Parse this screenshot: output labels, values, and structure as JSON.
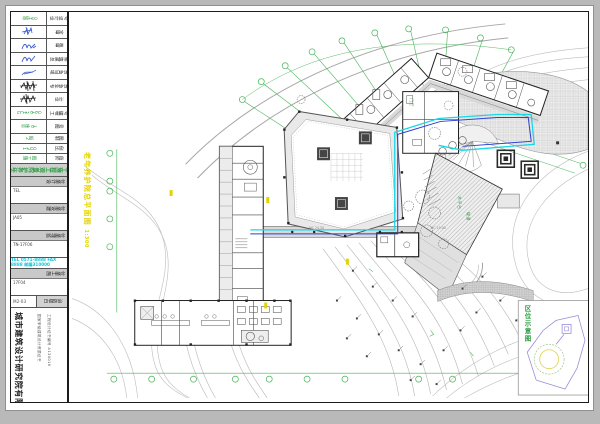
{
  "colors": {
    "grid_green": "#46b257",
    "highlight_cyan": "#18d7e6",
    "highlight_blue": "#2b3fd4",
    "title_yellow": "#e3d400",
    "contour_gray": "#b8b8b8"
  },
  "title_block": {
    "rows": [
      {
        "label": "设计证号",
        "value": "甲级100"
      },
      {
        "label": "审 定",
        "value": ""
      },
      {
        "label": "审 核",
        "value": ""
      },
      {
        "label": "总建筑师",
        "value": ""
      },
      {
        "label": "项目负责",
        "value": ""
      },
      {
        "label": "专业负责",
        "value": ""
      },
      {
        "label": "设 计",
        "value": ""
      },
      {
        "label": "工程编号",
        "value": "GC 13-0160"
      },
      {
        "label": "图 号",
        "value": "总施-01"
      }
    ],
    "info_rows": [
      {
        "label": "制 图",
        "value": "2期"
      },
      {
        "label": "比 例",
        "value": "1:300"
      },
      {
        "label": "阶 段",
        "value": "施工图"
      }
    ],
    "project_name": "老年养护院景观工程施工图",
    "sections": [
      {
        "code": "TEL",
        "bar_label": "设计单位"
      },
      {
        "code": "JA05",
        "bar_label": "建设单位"
      },
      {
        "code": "TN-17F06",
        "bar_label": "监理单位"
      },
      {
        "code": "17F04",
        "bar_label": "施工单位"
      }
    ],
    "contact_line": "TEL 0571-8888 FAX 8888 邮编310000",
    "pest": {
      "code": "M2-03",
      "bar_label": "白蚁防治"
    },
    "company_name": "城市建筑设计研究院有限公司",
    "company_col1": "国家甲级建筑设计资质证书",
    "company_col2": "工程设计证书编号 A130016"
  },
  "drawing": {
    "main_title": "老年养护院总平面图",
    "main_title_scale": "1:300",
    "inset_title": "区位示意图",
    "annotations": {
      "deck": "木平台",
      "ramp": "坡道",
      "lobby": "门厅",
      "dim1": "MC 24.50",
      "dim2": "MC 19.00"
    }
  }
}
